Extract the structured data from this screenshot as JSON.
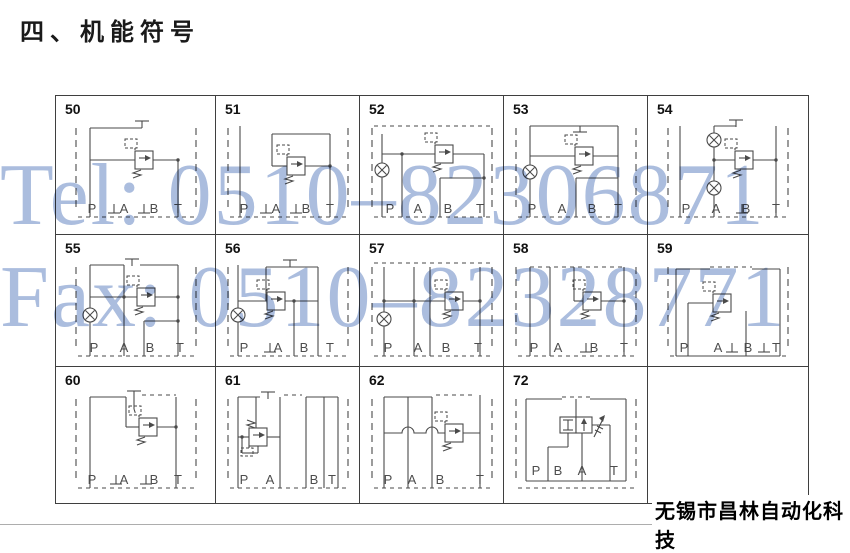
{
  "page": {
    "title": "四、机能符号",
    "company": "无锡市昌林自动化科技",
    "watermark": {
      "tel": "Tel: 0510–82306871",
      "fax": "Fax: 0510–82328771",
      "color": "#a7badd"
    },
    "line_color": "#4a4a4a",
    "border_color": "#3f3f3f"
  },
  "cells": [
    {
      "num": "50",
      "ports": [
        "P",
        "A",
        "B",
        "T"
      ],
      "symbols": [
        "relief-valve",
        "pilot-line",
        "spring",
        "plug-top",
        "plug-port-a",
        "plug-port-b"
      ]
    },
    {
      "num": "51",
      "ports": [
        "P",
        "A",
        "B",
        "T"
      ],
      "symbols": [
        "relief-valve",
        "pilot-line",
        "spring",
        "plug-port-a",
        "plug-port-b"
      ]
    },
    {
      "num": "52",
      "ports": [
        "P",
        "A",
        "B",
        "T"
      ],
      "symbols": [
        "relief-valve",
        "pilot-line",
        "spring",
        "gauge-port"
      ]
    },
    {
      "num": "53",
      "ports": [
        "P",
        "A",
        "B",
        "T"
      ],
      "symbols": [
        "relief-valve",
        "pilot-line",
        "spring",
        "gauge-port",
        "plug-top"
      ]
    },
    {
      "num": "54",
      "ports": [
        "P",
        "A",
        "B",
        "T"
      ],
      "symbols": [
        "relief-valve",
        "pilot-line",
        "spring",
        "gauge-port",
        "gauge-port",
        "plug-top",
        "plug-port-b"
      ]
    },
    {
      "num": "55",
      "ports": [
        "P",
        "A",
        "B",
        "T"
      ],
      "symbols": [
        "relief-valve",
        "pilot-line",
        "spring",
        "gauge-port",
        "plug-top"
      ]
    },
    {
      "num": "56",
      "ports": [
        "P",
        "A",
        "B",
        "T"
      ],
      "symbols": [
        "relief-valve",
        "pilot-line",
        "spring",
        "gauge-port",
        "plug-top",
        "plug-port-a"
      ]
    },
    {
      "num": "57",
      "ports": [
        "P",
        "A",
        "B",
        "T"
      ],
      "symbols": [
        "relief-valve",
        "pilot-line",
        "spring",
        "gauge-port"
      ]
    },
    {
      "num": "58",
      "ports": [
        "P",
        "A",
        "B",
        "T"
      ],
      "symbols": [
        "relief-valve",
        "pilot-line",
        "spring",
        "plug-port-b"
      ]
    },
    {
      "num": "59",
      "ports": [
        "P",
        "A",
        "B",
        "T"
      ],
      "symbols": [
        "relief-valve",
        "pilot-line",
        "spring",
        "plug-port-a",
        "plug-port-t"
      ]
    },
    {
      "num": "60",
      "ports": [
        "P",
        "A",
        "B",
        "T"
      ],
      "symbols": [
        "relief-valve",
        "pilot-line",
        "spring",
        "plug-top",
        "plug-port-a",
        "plug-port-b"
      ]
    },
    {
      "num": "61",
      "ports": [
        "P",
        "A",
        "B",
        "T"
      ],
      "symbols": [
        "relief-valve",
        "pilot-line",
        "spring",
        "plug-top"
      ]
    },
    {
      "num": "62",
      "ports": [
        "P",
        "A",
        "B",
        "T"
      ],
      "symbols": [
        "relief-valve",
        "pilot-line",
        "spring",
        "hose-crossing"
      ]
    },
    {
      "num": "72",
      "ports": [
        "P",
        "B",
        "A",
        "T"
      ],
      "symbols": [
        "directional-valve",
        "blocked-ports",
        "flow-arrow",
        "proportional-arrow"
      ]
    }
  ]
}
